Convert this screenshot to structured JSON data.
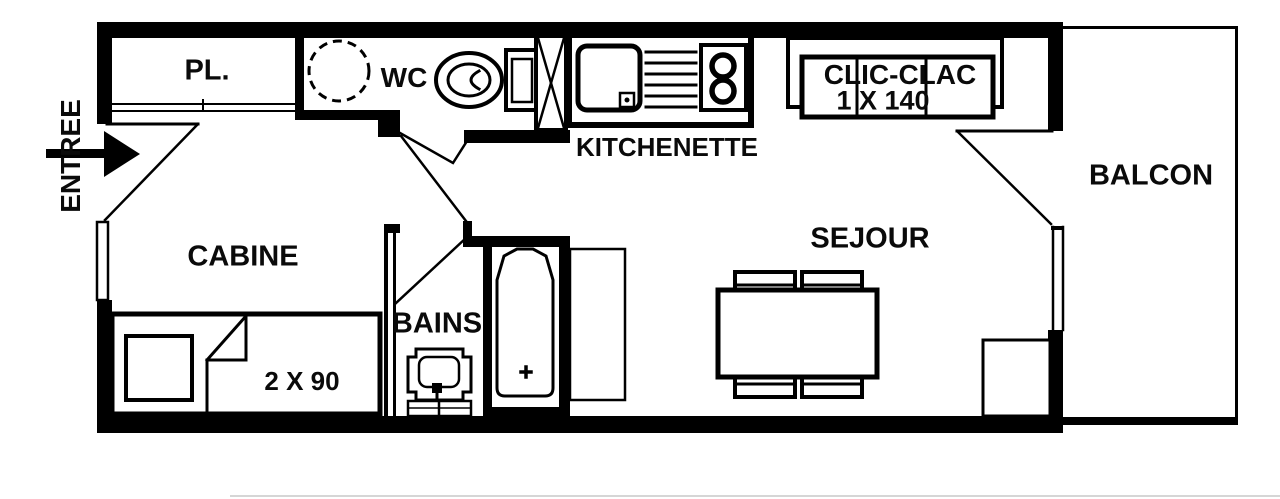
{
  "plan": {
    "type": "apartment-floor-plan",
    "labels": {
      "entree": "ENTREE",
      "pl": "PL.",
      "wc": "WC",
      "kitchenette": "KITCHENETTE",
      "clic_clac_model": "CLIC-CLAC",
      "clic_clac_size": "1 X 140",
      "balcon": "BALCON",
      "sejour": "SEJOUR",
      "cabine": "CABINE",
      "bains": "BAINS",
      "bed_size": "2 X 90"
    },
    "colors": {
      "wall": "#000000",
      "background": "#ffffff",
      "text": "#0a0a0a",
      "artifact": "#b5b5b5"
    }
  }
}
